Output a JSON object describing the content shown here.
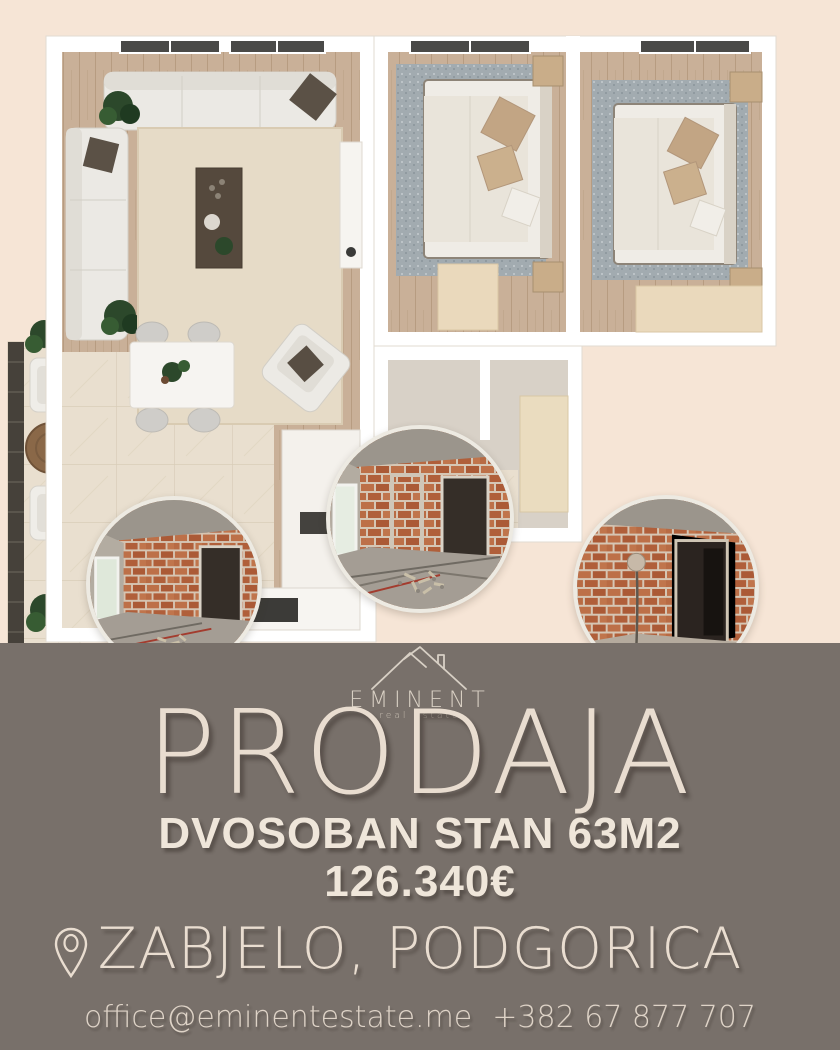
{
  "poster": {
    "background_color": "#f6e5d6",
    "band_color": "#78706a",
    "text_color": "#ece1d5"
  },
  "brand": {
    "logo_icon": "roof-peaks-icon",
    "name": "EMINENT",
    "tagline": "real estate"
  },
  "listing": {
    "headline": "PRODAJA",
    "property_title": "DVOSOBAN STAN 63M2",
    "price": "126.340€",
    "location": "ZABJELO, PODGORICA",
    "location_icon": "location-pin-icon",
    "email": "office@eminentestate.me",
    "phone": "+382 67 877 707"
  },
  "media": {
    "floor_plan": "apartment-3d-floor-plan",
    "photos": [
      "construction-interior-photo-1",
      "construction-interior-photo-2",
      "construction-interior-photo-3"
    ]
  }
}
